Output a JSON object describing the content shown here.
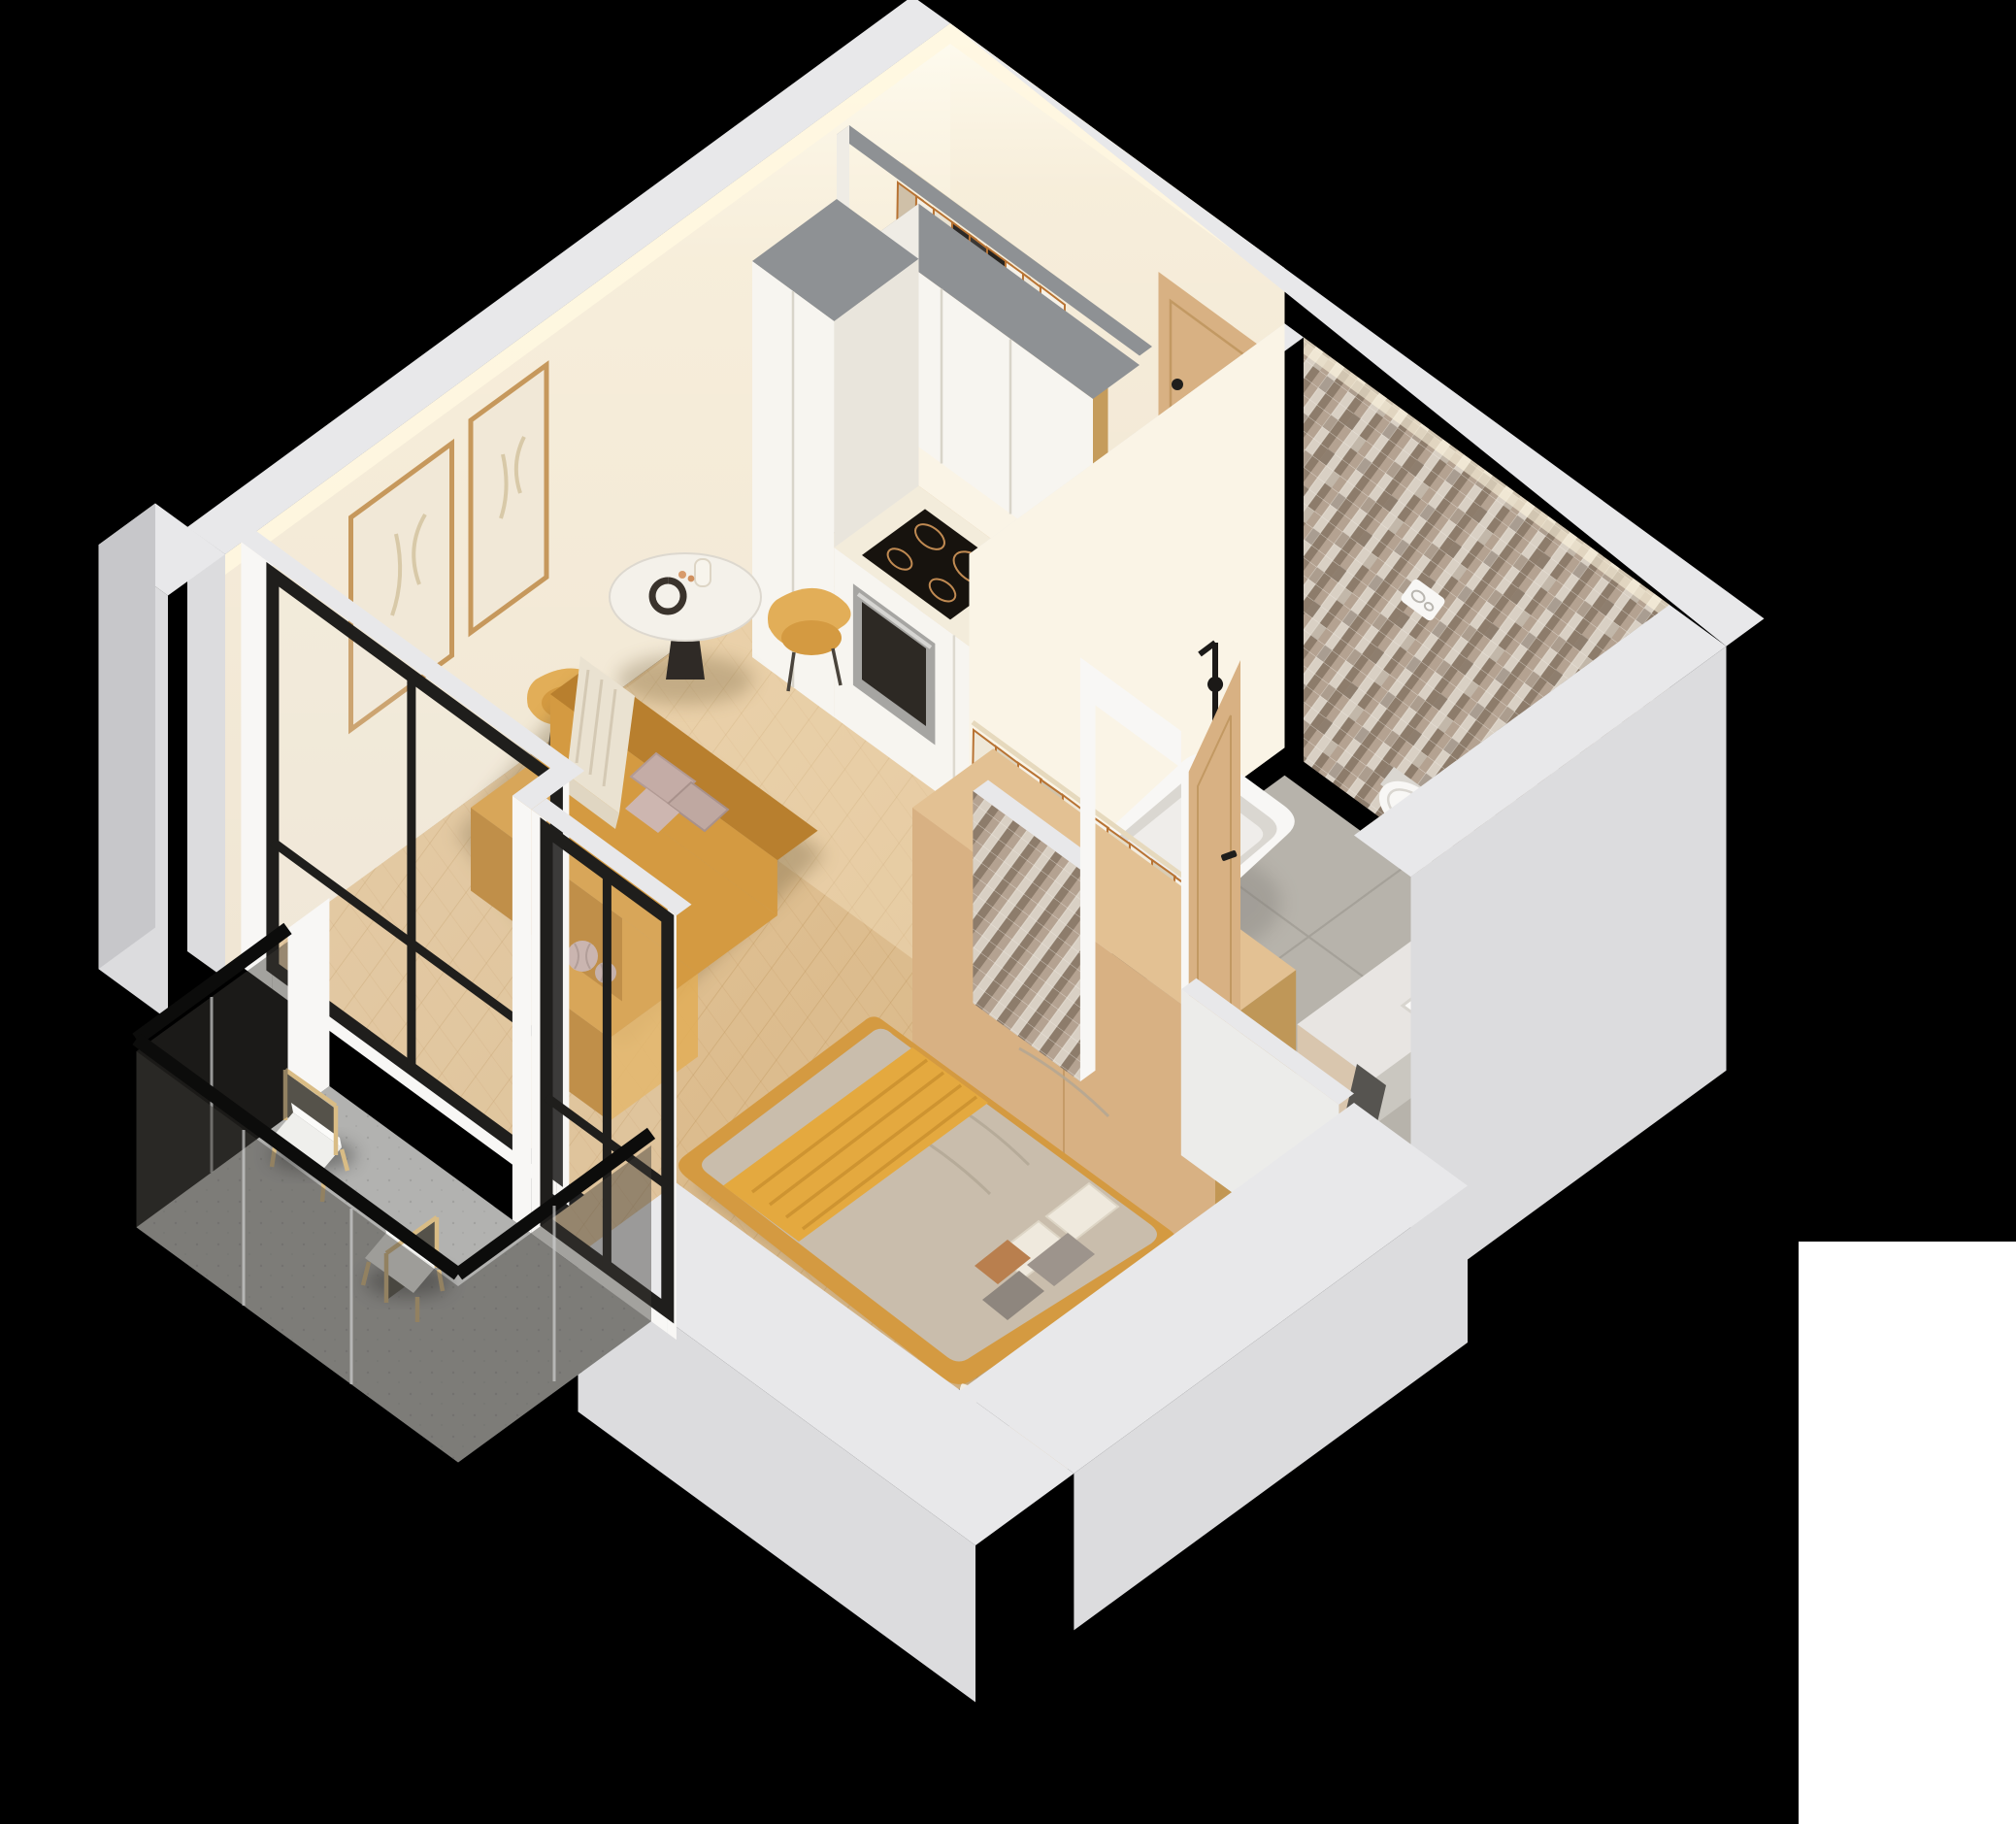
{
  "scene": {
    "title": "Isometric 3D cutaway floor plan render of a studio apartment on a black background",
    "type": "architectural-3d-floor-plan",
    "background": "#000000",
    "view": "isometric top-down cutaway",
    "text_visible": false
  },
  "palette": {
    "wall_top": "#e8e8ea",
    "wall_outer": "#dcdcde",
    "wall_outer2": "#c7c7ca",
    "wall_warm": "#f0e6d4",
    "wall_warm_lt": "#faf4e6",
    "gray_top": "#8e9194",
    "wood_floor": "#ddbd8f",
    "wood_floor_dk": "#c9a26b",
    "wood_line": "#b98e55",
    "cab_white": "#f7f5f0",
    "cab_shade": "#e9e5dc",
    "cab_side": "#efece5",
    "counter": "#f3ecdb",
    "appliance_dark": "#17130e",
    "steel": "#a6a5a2",
    "wood": "#d8b183",
    "wood_dk": "#c0934f",
    "mustard": "#d49a41",
    "mustard_dk": "#b87f2e",
    "mustard_lt": "#e2ae58",
    "cream": "#eae2d1",
    "greige": "#c9bdac",
    "yellow": "#e4a93f",
    "pillow_pink": "#c4aca6",
    "black_frame": "#1f1e1c",
    "glass": "#dfe5e6",
    "smoke": "#3c3a35",
    "bath_floor": "#b7b3ab",
    "bath_line": "#a19d95",
    "mosaic1": "#b4a291",
    "mosaic2": "#8d7c6b",
    "mosaic3": "#d9d0c4",
    "mosaic4": "#6e6052",
    "white_fix": "#f8f7f5",
    "fix_shade": "#dad7d1",
    "balcony_floor": "#b2b2b0",
    "art_frame": "#c6985c",
    "paper": "#f1e8d7",
    "towel": "#565450",
    "plant": "#46653c",
    "led": "#fff7e0",
    "watermark": "#ffffff"
  },
  "rooms": [
    {
      "id": "living-kitchen",
      "label": "Living room with kitchen",
      "items": [
        "white kitchen cabinets",
        "gray cabinet tops",
        "induction cooktop",
        "built-in oven",
        "black sink",
        "tall cabinet column",
        "two framed wall artworks",
        "round marble dining table",
        "two mustard dining chairs",
        "mustard sofa",
        "cream throw",
        "pink pillows",
        "pumpkin pillows",
        "chevron parquet floor",
        "black framed window"
      ]
    },
    {
      "id": "hallway",
      "label": "Entry hall",
      "items": [
        "open wardrobe with hanging clothes",
        "wooden clothes rail",
        "wooden entry door with black handle"
      ]
    },
    {
      "id": "bathroom",
      "label": "Bathroom",
      "items": [
        "brown mosaic tile walls",
        "gray tile floor",
        "wall-hung toilet",
        "flush plate",
        "freestanding white bathtub",
        "black floor faucet",
        "white vanity with sink",
        "black tap",
        "storage basket",
        "dark towel",
        "wooden door ajar"
      ]
    },
    {
      "id": "bedroom",
      "label": "Bedroom",
      "items": [
        "double bed with mustard frame",
        "greige duvet",
        "yellow throw",
        "white gray and caramel pillows",
        "open wardrobe with cream clothes",
        "round black bedside table",
        "plant",
        "book",
        "black framed window",
        "round mustard stool"
      ]
    },
    {
      "id": "balcony",
      "label": "Balcony",
      "items": [
        "gray concrete floor",
        "smoked glass railing with black cap",
        "two wooden lounge chairs with white cushions"
      ]
    }
  ],
  "watermark_block": {
    "present": true,
    "position": "bottom-right",
    "color": "#ffffff"
  }
}
